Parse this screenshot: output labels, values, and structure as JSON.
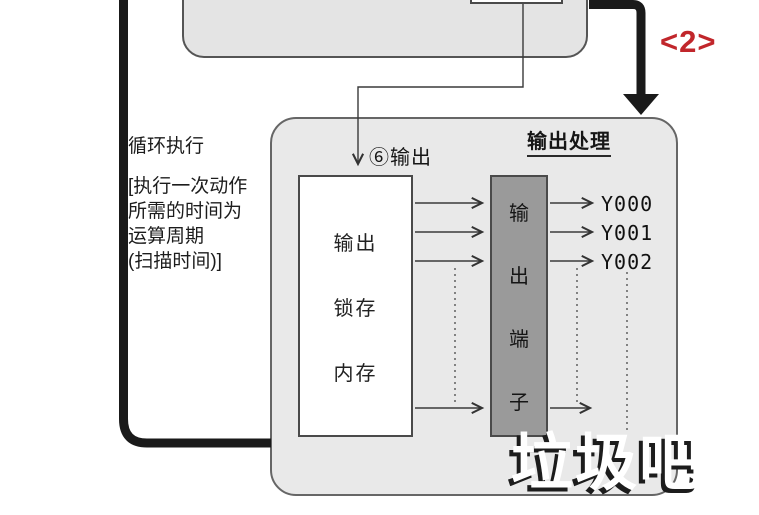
{
  "colors": {
    "accent-red": "#c1262b",
    "container-fill": "#e9e9e9",
    "top-box-fill": "#e4e4e4",
    "terminal-fill": "#9a9a9a",
    "line-dark": "#1a1a1a",
    "watermark-shadow": "#1c1c1c"
  },
  "annotations": {
    "step_tag": "<2>",
    "cycle_label": "循环执行",
    "cycle_note_lines": [
      "[执行一次动作",
      "所需的时间为",
      "运算周期",
      "(扫描时间)]"
    ],
    "step_output_label": "⑥输出"
  },
  "diagram": {
    "title": "输出处理",
    "latch_box": {
      "lines": [
        "输出",
        "锁存",
        "内存"
      ]
    },
    "terminal_box": {
      "chars": [
        "输",
        "出",
        "端",
        "子"
      ]
    },
    "outputs": [
      "Y000",
      "Y001",
      "Y002"
    ]
  },
  "watermark": "垃圾吧"
}
